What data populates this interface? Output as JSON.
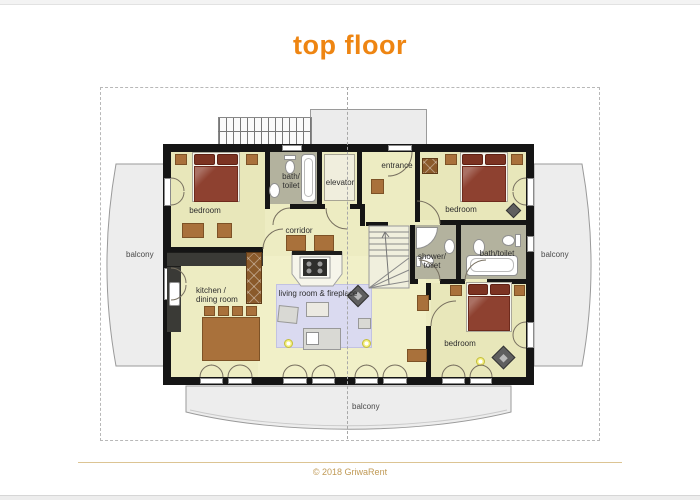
{
  "page": {
    "title": "top floor",
    "copyright": "© 2018 GriwaRent"
  },
  "colors": {
    "title_orange": "#ee8512",
    "copyright_tan": "#c09a56",
    "floor_yellow": "#edecc2",
    "bedroom_floor": "#e8e7ba",
    "bathroom_floor": "#b3b29e",
    "wall_black": "#151515",
    "bed_red": "#8e4130",
    "wood_brown": "#a9713b",
    "rug_lavender": "#dadaf0",
    "balcony_gray": "#ededed",
    "lamp_yellow": "#f4ef7b"
  },
  "plan": {
    "rooms": {
      "bedroom_left": {
        "label": "bedroom"
      },
      "bedroom_right": {
        "label": "bedroom"
      },
      "bedroom_bottom": {
        "label": "bedroom"
      },
      "bath_toilet_top": {
        "line1": "bath/",
        "line2": "toilet"
      },
      "bath_toilet_right": {
        "label": "bath/toilet"
      },
      "shower_toilet": {
        "line1": "shower/",
        "line2": "toilet"
      },
      "elevator": {
        "label": "elevator"
      },
      "entrance": {
        "label": "entrance"
      },
      "corridor": {
        "label": "corridor"
      },
      "kitchen": {
        "line1": "kitchen /",
        "line2": "dining room"
      },
      "living": {
        "label": "living room & fireplace"
      },
      "balcony_left": {
        "label": "balcony"
      },
      "balcony_right": {
        "label": "balcony"
      },
      "balcony_bottom": {
        "label": "balcony"
      }
    }
  }
}
